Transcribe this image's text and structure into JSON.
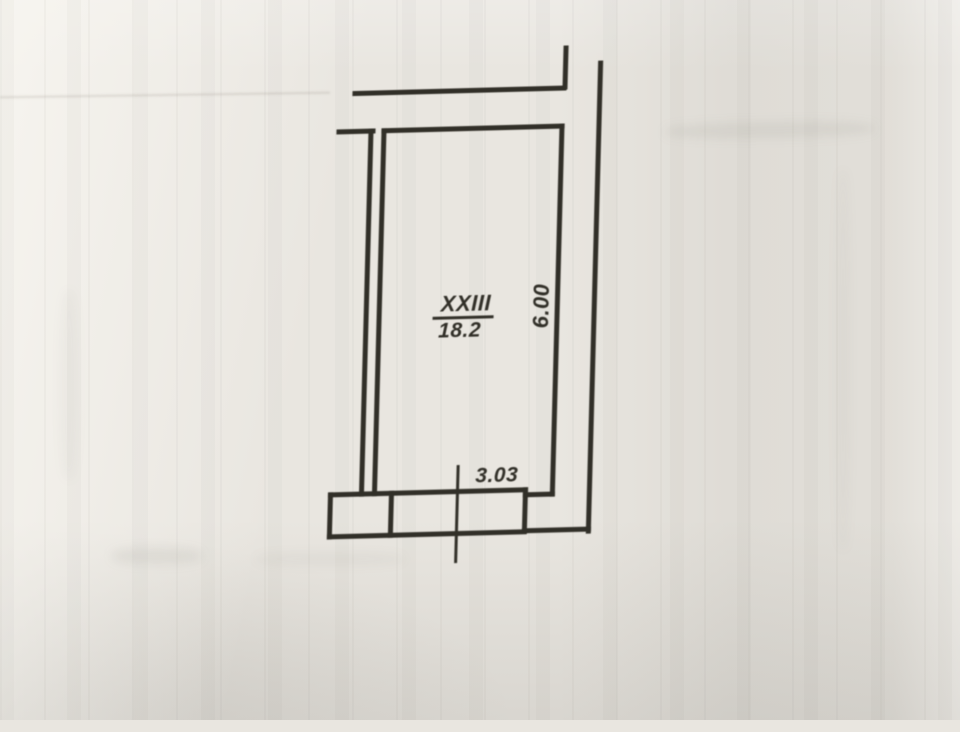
{
  "plan": {
    "room_number": "XXIII",
    "room_area": "18.2",
    "dim_vertical": "6.00",
    "dim_horizontal": "3.03"
  },
  "colors": {
    "ink": "#312f28",
    "paper": "#e9e6e0"
  }
}
